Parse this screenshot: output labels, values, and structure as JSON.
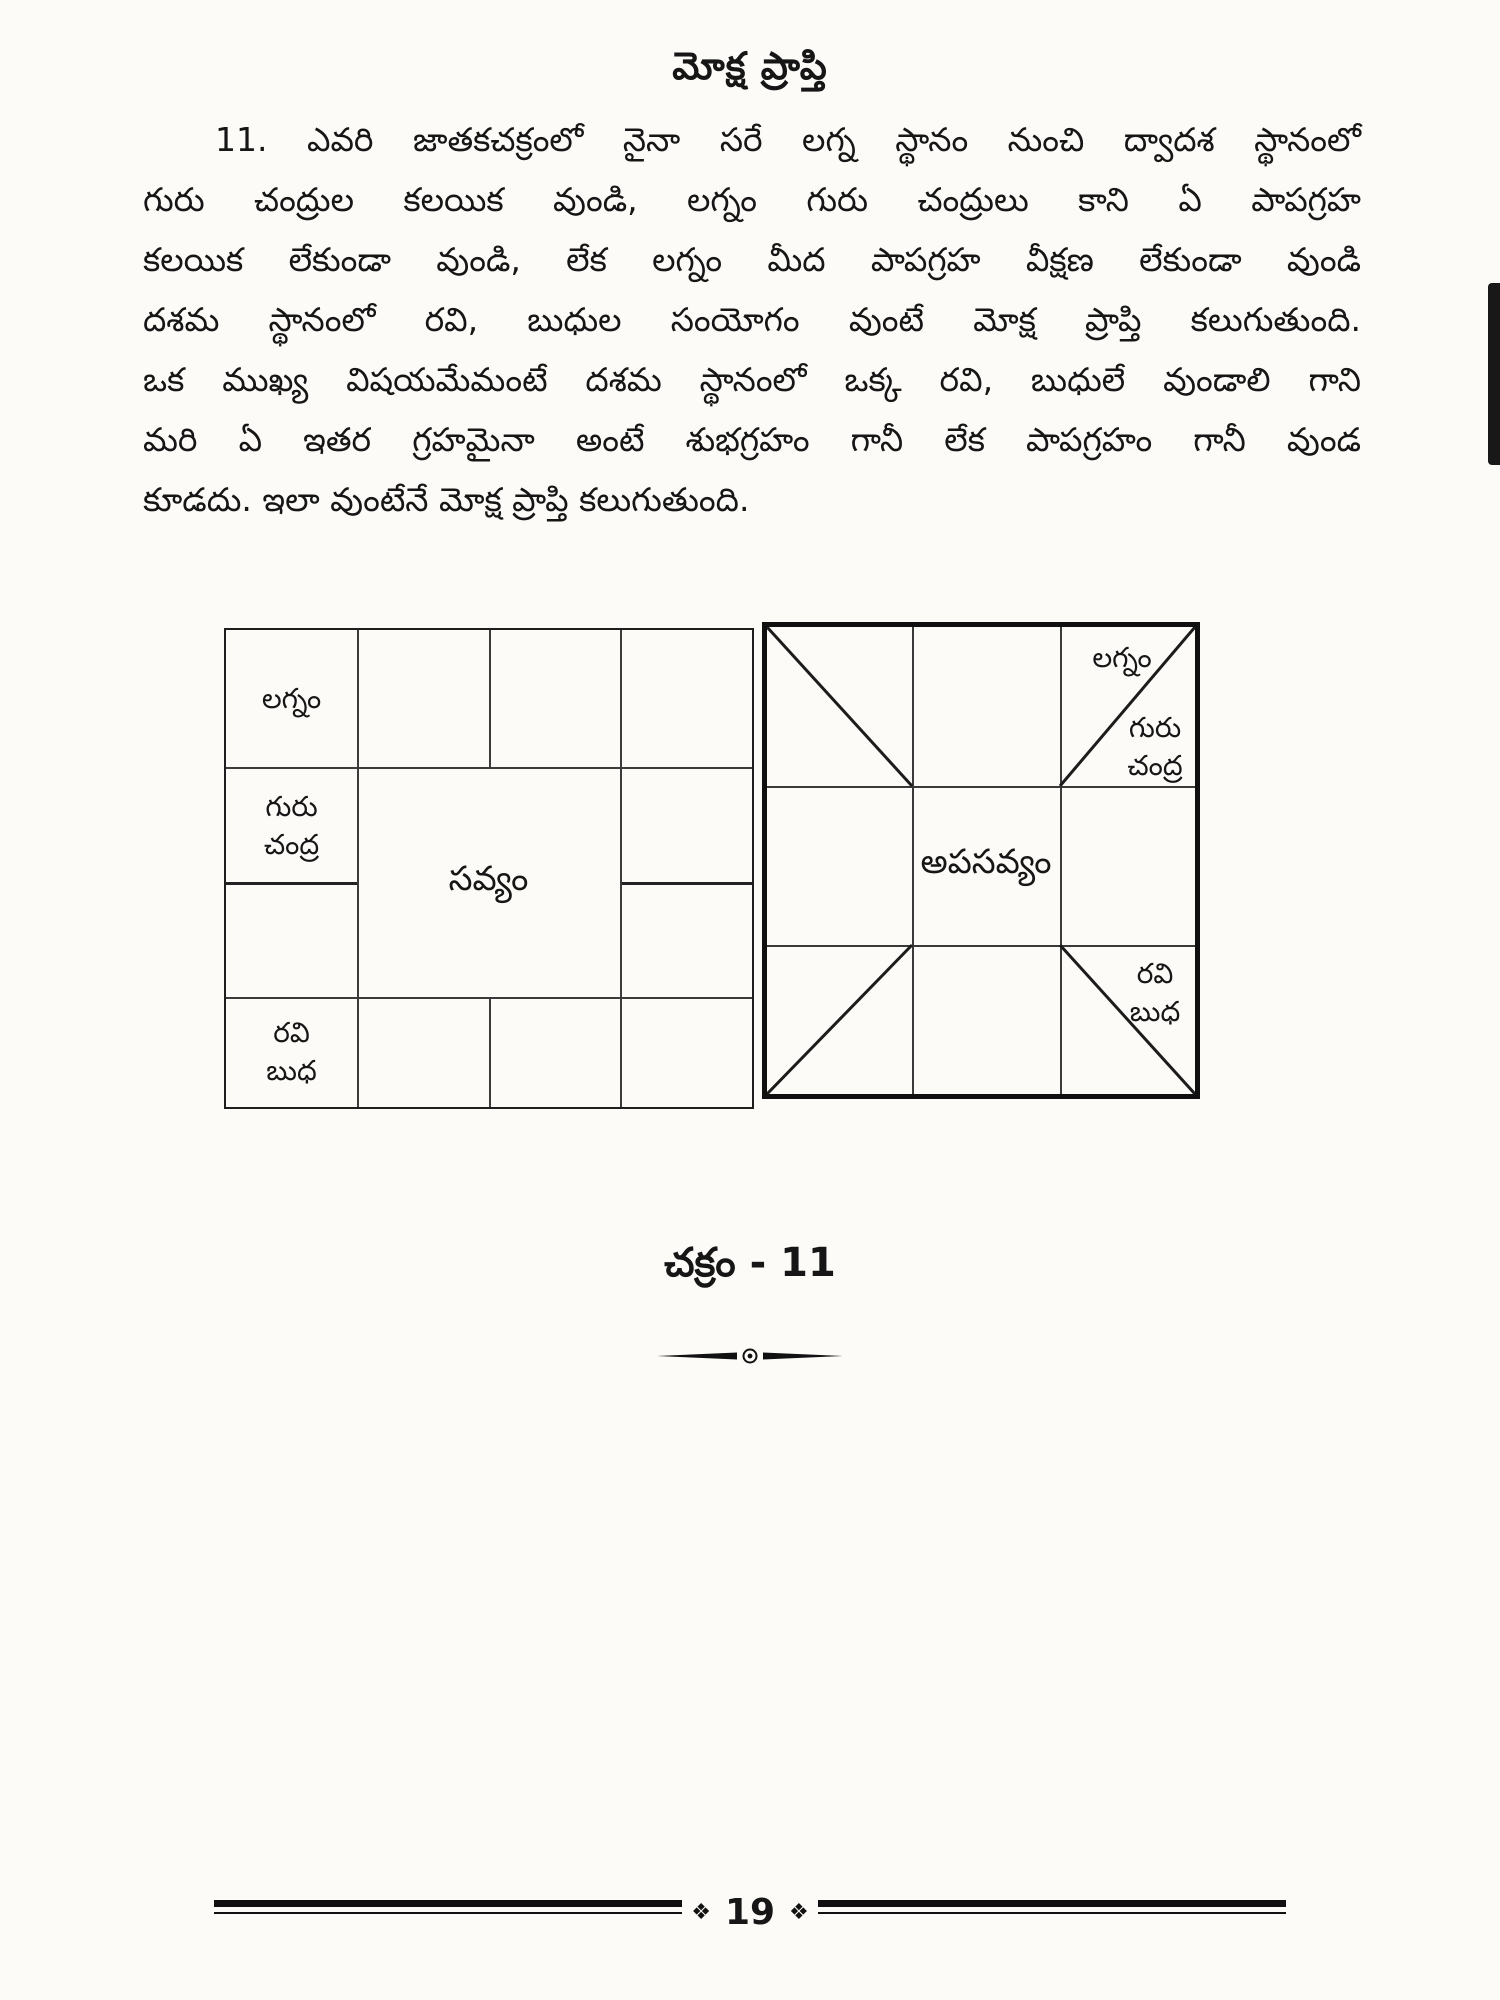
{
  "page": {
    "title": "మోక్ష ప్రాప్తి",
    "paragraph_lines": [
      "11. ఎవరి జాతకచక్రంలో నైనా సరే లగ్న స్థానం నుంచి ద్వాదశ స్థానంలో",
      "గురు చంద్రుల కలయిక వుండి, లగ్నం గురు చంద్రులు కాని ఏ పాపగ్రహ",
      "కలయిక లేకుండా వుండి, లేక లగ్నం మీద పాపగ్రహ వీక్షణ లేకుండా వుండి",
      "దశమ స్థానంలో రవి, బుధుల సంయోగం వుంటే మోక్ష ప్రాప్తి కలుగుతుంది.",
      "ఒక ముఖ్య విషయమేమంటే దశమ స్థానంలో ఒక్క రవి, బుధులే వుండాలి గాని",
      "మరి ఏ ఇతర గ్రహమైనా అంటే శుభగ్రహం గానీ లేక పాపగ్రహం గానీ వుండ",
      "కూడదు. ఇలా వుంటేనే మోక్ష ప్రాప్తి కలుగుతుంది."
    ],
    "caption": "చక్రం - 11",
    "footer": {
      "page_number": "19",
      "ornament_left": "❖",
      "ornament_right": "❖"
    }
  },
  "charts": {
    "left": {
      "type": "south-indian-rasi-chart",
      "direction_label": "సవ్యం",
      "cells": {
        "lagnam": "లగ్నం",
        "guru": "గురు",
        "chandra": "చంద్ర",
        "ravi": "రవి",
        "budha": "బుధ"
      }
    },
    "right": {
      "type": "south-indian-rasi-chart-with-diagonals",
      "direction_label": "అపసవ్యం",
      "cells": {
        "lagnam": "లగ్నం",
        "guru": "గురు",
        "chandra": "చంద్ర",
        "ravi": "రవి",
        "budha": "బుధ"
      }
    }
  },
  "colors": {
    "paper": "#fcfbf8",
    "ink": "#161616",
    "thin_line": "#3a3a3a",
    "thick_border": "#101010"
  }
}
